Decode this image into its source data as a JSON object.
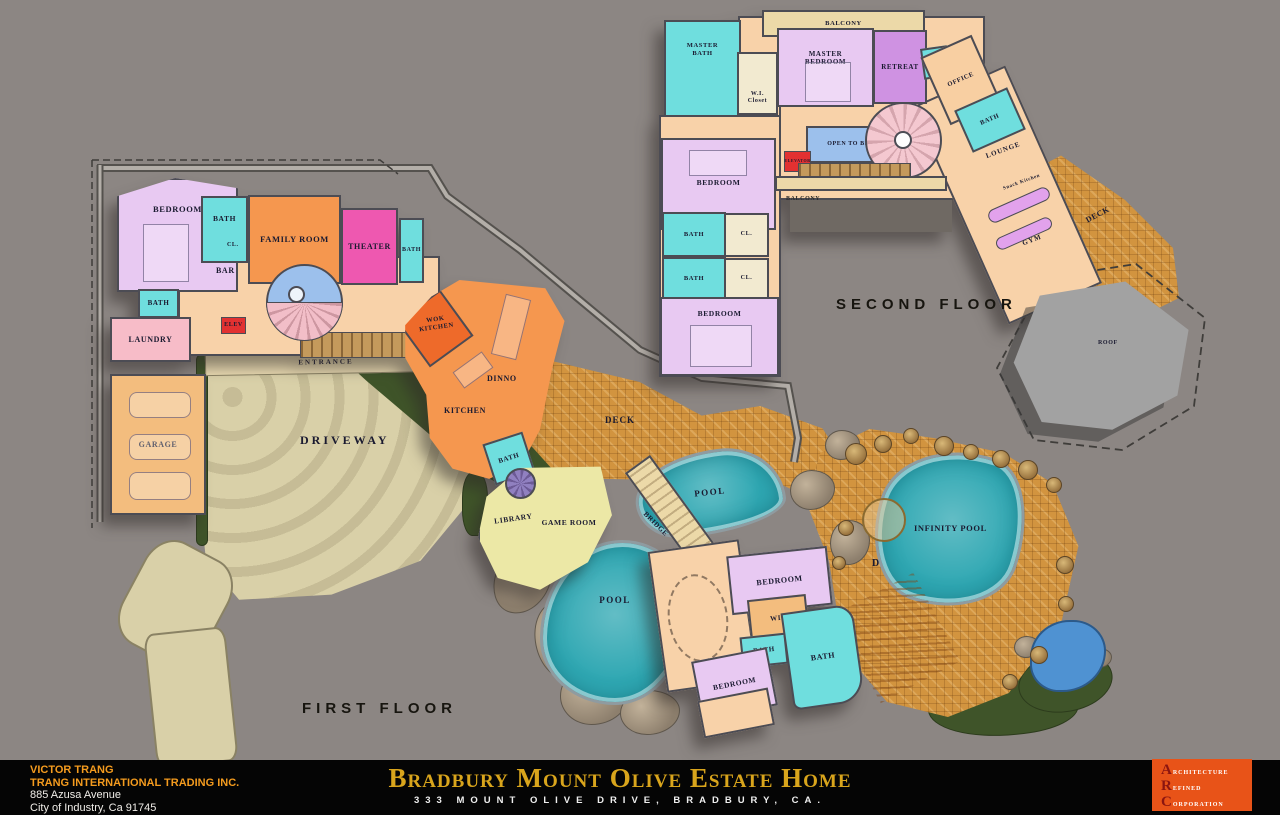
{
  "palette": {
    "background": "#8c8683",
    "wall_outline": "#4c4c54",
    "bedroom_lavender": "#e8c9f2",
    "bath_cyan": "#6fdede",
    "family_room_orange": "#f5974f",
    "theater_pink": "#ee58b0",
    "hall_peach": "#f8d2a9",
    "laundry_pink": "#f7bcc8",
    "garage_tan": "#f3bd7e",
    "closet_cream": "#f2ead0",
    "game_room_yellow": "#ece8a6",
    "retreat_purple": "#cf92e2",
    "pool_teal": "#2ea7b2",
    "deck_tile": "#d2943f",
    "driveway_beige": "#d9d0a8",
    "landscape_green": "#3f5429",
    "stair_blue": "#9cc0ec",
    "elevator_red": "#e23131",
    "roof_gray": "#a2a2a2",
    "title_gold": "#d9a51c",
    "logo_orange": "#e85318",
    "credit_orange": "#f49b1e"
  },
  "plan": {
    "first_floor_label": "FIRST FLOOR",
    "second_floor_label": "SECOND FLOOR",
    "rooms": {
      "bedroom": "BEDROOM",
      "bath": "BATH",
      "closet": "CL.",
      "family_room": "FAMILY ROOM",
      "theater": "THEATER",
      "bar": "BAR",
      "laundry": "LAUNDRY",
      "elevator_short": "ELEV",
      "garage": "GARAGE",
      "entrance": "ENTRANCE",
      "driveway": "DRIVEWAY",
      "wok_kitchen": "WOK KITCHEN",
      "dining": "DINNO",
      "kitchen": "KITCHEN",
      "deck": "DECK",
      "library": "LIBRARY",
      "game_room": "GAME ROOM",
      "pool": "POOL",
      "bridge": "BRIDGE",
      "wic": "WIC",
      "infinity_pool": "INFINITY POOL",
      "balcony": "BALCONY",
      "master_bath": "MASTER BATH",
      "wi_closet": "W.I. Closet",
      "master_bedroom": "MASTER BEDROOM",
      "retreat": "RETREAT",
      "office": "OFFICE",
      "open_to_below": "OPEN TO BELOW",
      "elevator": "ELEVATOR",
      "lounge": "LOUNGE",
      "snack_kitchen": "Snack Kitchen",
      "gym": "GYM",
      "roof": "ROOF"
    }
  },
  "title_block": {
    "owner_name": "VICTOR TRANG",
    "owner_company": "TRANG INTERNATIONAL TRADING INC.",
    "owner_address1": "885  Azusa  Avenue",
    "owner_address2": "City of Industry, Ca 91745",
    "project_title": "Bradbury Mount Olive Estate Home",
    "project_address": "333 MOUNT OLIVE DRIVE, BRADBURY, CA.",
    "logo_line1": "Architecture",
    "logo_line2": "Refined",
    "logo_line3": "Corporation"
  }
}
